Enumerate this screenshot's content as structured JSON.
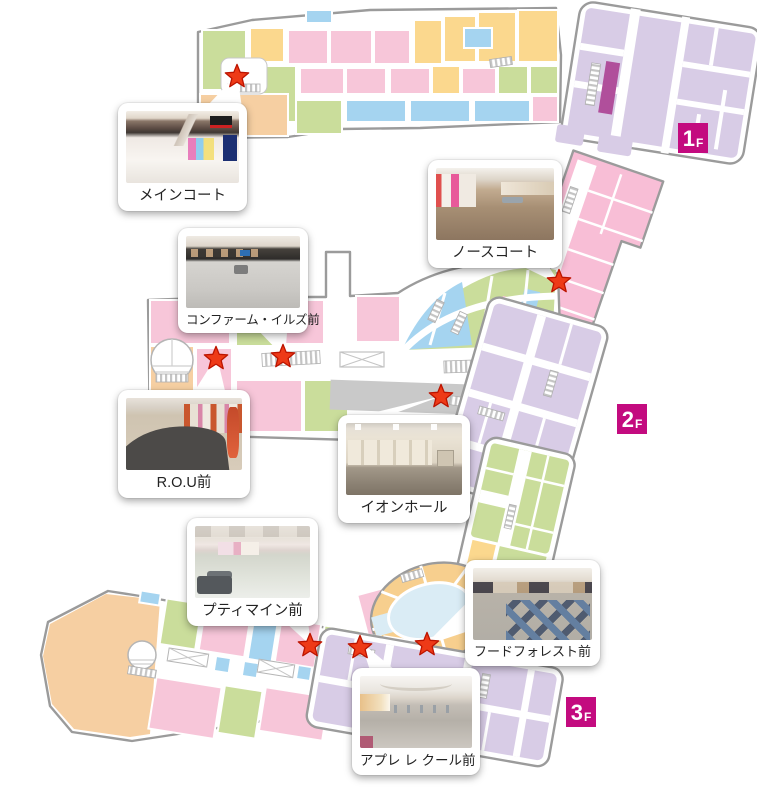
{
  "floors": [
    {
      "id": "1F",
      "badge": {
        "number": "1",
        "suffix": "F"
      }
    },
    {
      "id": "2F",
      "badge": {
        "number": "2",
        "suffix": "F"
      }
    },
    {
      "id": "3F",
      "badge": {
        "number": "3",
        "suffix": "F"
      }
    }
  ],
  "callouts": [
    {
      "id": "main-court",
      "floor": "1F",
      "label": "メインコート"
    },
    {
      "id": "north-court",
      "floor": "2F",
      "label": "ノースコート"
    },
    {
      "id": "confirm-ills",
      "floor": "2F",
      "label": "コンファーム・イルズ前"
    },
    {
      "id": "rou",
      "floor": "2F",
      "label": "R.O.U前"
    },
    {
      "id": "aeon-hall",
      "floor": "2F",
      "label": "イオンホール"
    },
    {
      "id": "petit-main",
      "floor": "3F",
      "label": "プティマイン前"
    },
    {
      "id": "food-forest",
      "floor": "3F",
      "label": "フードフォレスト前"
    },
    {
      "id": "apres-les-cours",
      "floor": "3F",
      "label": "アプレ レ クール前"
    }
  ],
  "legend_colors": {
    "store_pink": "#f7c6d9",
    "store_green": "#cadd9b",
    "store_yellow": "#fbd88e",
    "store_blue": "#a5d4f0",
    "store_orange": "#f6cfa2",
    "store_lavender": "#d8cce6",
    "magenta_accent": "#b04f9b",
    "hall_gray": "#c9c9c9",
    "badge_magenta": "#c30b7f",
    "star_red": "#ee3a17",
    "pond_blue": "#daecf5",
    "food_court_yellow": "#f7cf8e",
    "outline_gray": "#9b9b9b"
  }
}
